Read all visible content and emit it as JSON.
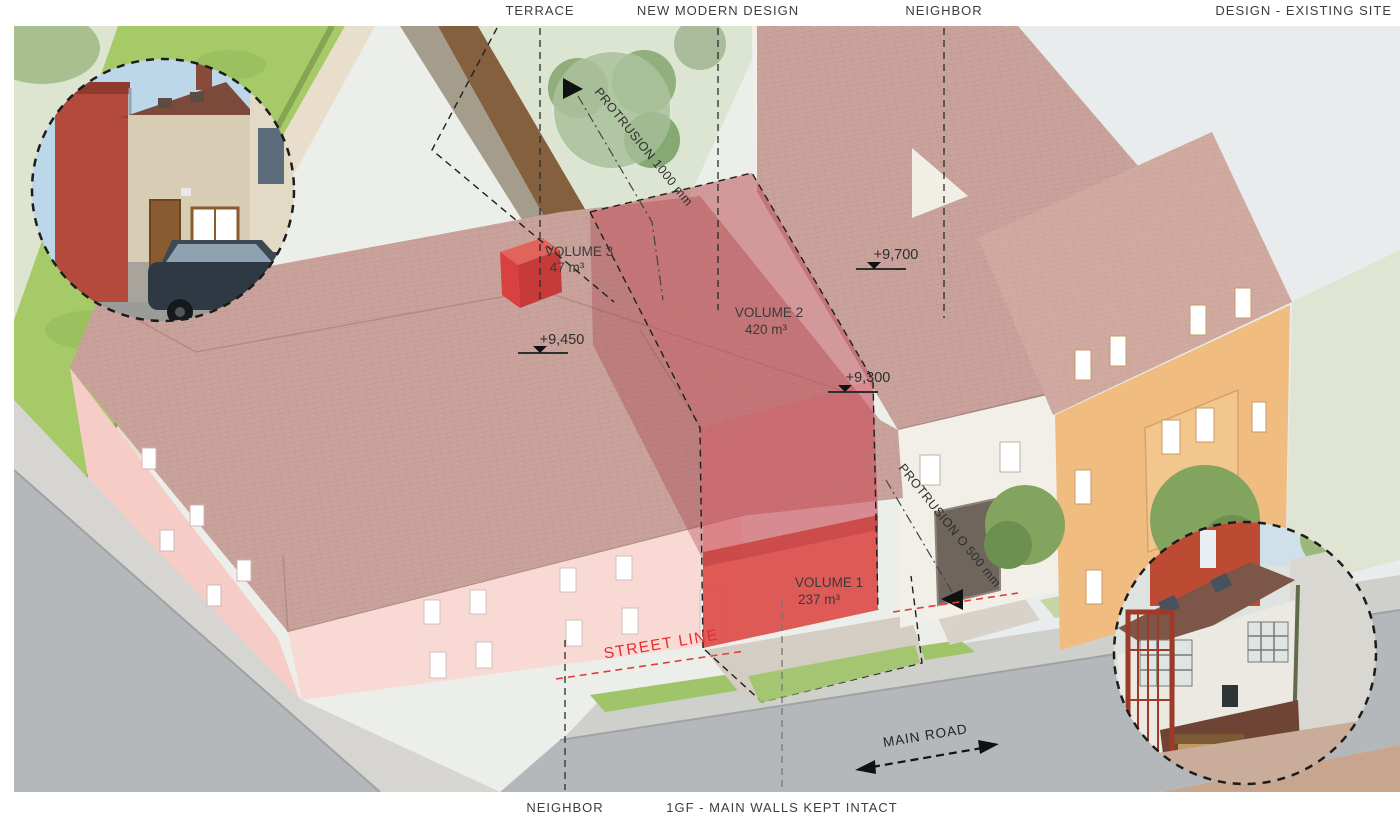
{
  "header": {
    "terrace": "TERRACE",
    "new_modern_design": "NEW MODERN DESIGN",
    "neighbor": "NEIGHBOR",
    "design_existing_site": "DESIGN - EXISTING SITE"
  },
  "footer": {
    "neighbor": "NEIGHBOR",
    "ground_floor_note": "1GF - MAIN WALLS KEPT INTACT"
  },
  "volumes": {
    "v1": {
      "label": "VOLUME 1",
      "value": "237 m³"
    },
    "v2": {
      "label": "VOLUME 2",
      "value": "420 m³"
    },
    "v3": {
      "label": "VOLUME 3",
      "value": "47 m³"
    }
  },
  "levels": {
    "existing_ridge": "+9,450",
    "neighbor_ridge": "+9,700",
    "new_volume_top": "+9,300"
  },
  "notes": {
    "protrusion_back": "PROTRUSION 1000 mm",
    "protrusion_front": "PROTRUSION O 500 mm",
    "street_line": "STREET LINE",
    "main_road": "MAIN ROAD"
  },
  "colors": {
    "new_volume_red": "#c94d58",
    "solid_red": "#dd4f4b",
    "roof_tile": "#cba49d",
    "existing_wall_pink": "#f8d8d2",
    "street_line_red": "#e22d2d",
    "lawn_green": "#a7ca68",
    "road_gray": "#b5b8ba",
    "orange_house": "#f0bc80",
    "label_gray": "#3e3e3e"
  }
}
